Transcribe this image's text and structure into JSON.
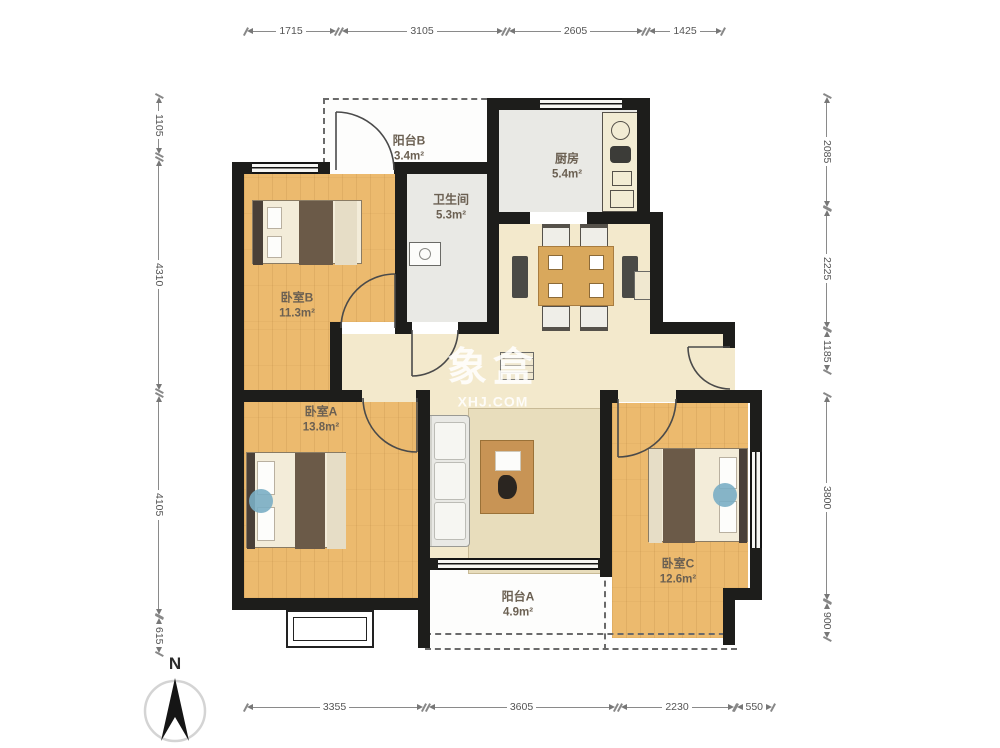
{
  "rooms": {
    "balcony_b": {
      "name": "阳台B",
      "area": "3.4m²"
    },
    "kitchen": {
      "name": "厨房",
      "area": "5.4m²"
    },
    "bathroom": {
      "name": "卫生间",
      "area": "5.3m²"
    },
    "bedroom_b": {
      "name": "卧室B",
      "area": "11.3m²"
    },
    "bedroom_a": {
      "name": "卧室A",
      "area": "13.8m²"
    },
    "bedroom_c": {
      "name": "卧室C",
      "area": "12.6m²"
    },
    "balcony_a": {
      "name": "阳台A",
      "area": "4.9m²"
    }
  },
  "dimensions": {
    "top": [
      "1715",
      "3105",
      "2605",
      "1425"
    ],
    "bottom": [
      "3355",
      "3605",
      "2230",
      "550"
    ],
    "left": [
      "1105",
      "4310",
      "4105",
      "615"
    ],
    "right": [
      "2085",
      "2225",
      "1185",
      "3800",
      "900"
    ]
  },
  "watermark": {
    "line1": "象盒",
    "line2": "XHJ.COM"
  },
  "compass": {
    "north": "N"
  },
  "colors": {
    "wall": "#1d1d1b",
    "wood_floor": "#ecba6e",
    "tile_floor": "#e9e9e5",
    "living_floor": "#f3e9cc",
    "balcony_floor": "#fdfdfc",
    "accent_blue": "#7aaec4"
  }
}
